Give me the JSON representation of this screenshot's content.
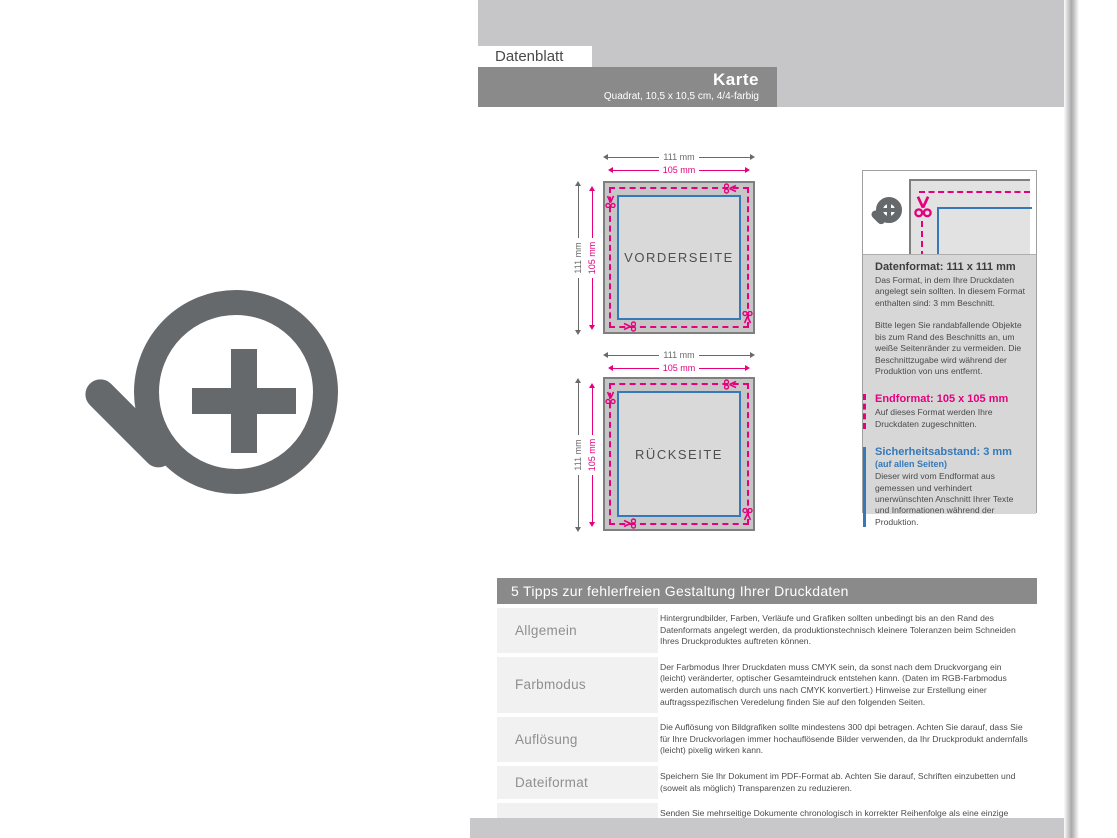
{
  "header": {
    "tab": "Datenblatt",
    "title": "Karte",
    "subtitle": "Quadrat, 10,5 x 10,5 cm, 4/4-farbig"
  },
  "diagrams": [
    {
      "label": "VORDERSEITE",
      "outer_width": "111 mm",
      "inner_width": "105 mm",
      "outer_height": "111 mm",
      "inner_height": "105 mm"
    },
    {
      "label": "RÜCKSEITE",
      "outer_width": "111 mm",
      "inner_width": "105 mm",
      "outer_height": "111 mm",
      "inner_height": "105 mm"
    }
  ],
  "infobox": {
    "datenformat_title": "Datenformat: 111 x 111 mm",
    "datenformat_p1": "Das Format, in dem Ihre Druckdaten angelegt sein sollten. In diesem Format enthalten sind: 3 mm Beschnitt.",
    "datenformat_p2": "Bitte legen Sie randabfallende Objekte bis zum Rand des Beschnitts an, um weiße Seitenränder zu vermeiden. Die Beschnittzugabe wird während der Produktion von uns entfernt.",
    "endformat_title": "Endformat: 105 x 105 mm",
    "endformat_p": "Auf dieses Format werden Ihre Druckdaten zugeschnitten.",
    "sicherheit_title": "Sicherheitsabstand: 3 mm",
    "sicherheit_sub": "(auf allen Seiten)",
    "sicherheit_p": "Dieser wird vom Endformat aus gemessen und verhindert unerwünschten Anschnitt Ihrer Texte und Informationen während der Produktion."
  },
  "tips": {
    "title": "5 Tipps zur fehlerfreien Gestaltung Ihrer Druckdaten",
    "rows": [
      {
        "label": "Allgemein",
        "text": "Hintergrundbilder, Farben, Verläufe und Grafiken sollten unbedingt bis an den Rand des Datenformats angelegt werden, da produktionstechnisch kleinere Toleranzen beim Schneiden Ihres Druckproduktes auftreten können."
      },
      {
        "label": "Farbmodus",
        "text": "Der Farbmodus Ihrer Druckdaten muss CMYK sein, da sonst nach dem Druckvorgang ein (leicht) veränderter, optischer Gesamteindruck entstehen kann. (Daten im RGB-Farbmodus werden automatisch durch uns nach CMYK konvertiert.) Hinweise zur Erstellung einer auftragsspezifischen Veredelung finden Sie auf den folgenden Seiten."
      },
      {
        "label": "Auflösung",
        "text": "Die Auflösung von Bildgrafiken sollte mindestens 300 dpi betragen. Achten Sie darauf, dass Sie für Ihre Druckvorlagen immer hochauflösende Bilder verwenden, da Ihr Druckprodukt andernfalls (leicht) pixelig wirken kann."
      },
      {
        "label": "Dateiformat",
        "text": "Speichern Sie Ihr Dokument im PDF-Format ab. Achten Sie darauf, Schriften einzubetten und (soweit als möglich) Transparenzen zu reduzieren."
      },
      {
        "label": "Seiten(-reihenfolge)",
        "text": "Senden Sie mehrseitige Dokumente chronologisch in korrekter Reihenfolge als eine einzige PDF-Datei oder benennen Sie Einzeldokumente entsprechend mit fortlaufenden Seitennummern."
      }
    ]
  },
  "icons": {
    "zoom_icon": "magnifier-plus",
    "scissors_icon": "scissors"
  },
  "colors": {
    "magenta": "#e6007e",
    "blue": "#3579b8",
    "bar_gray": "#8a8a8a",
    "light_gray": "#c6c6c8",
    "panel_gray": "#d7d7d7",
    "icon_gray": "#65696c"
  }
}
